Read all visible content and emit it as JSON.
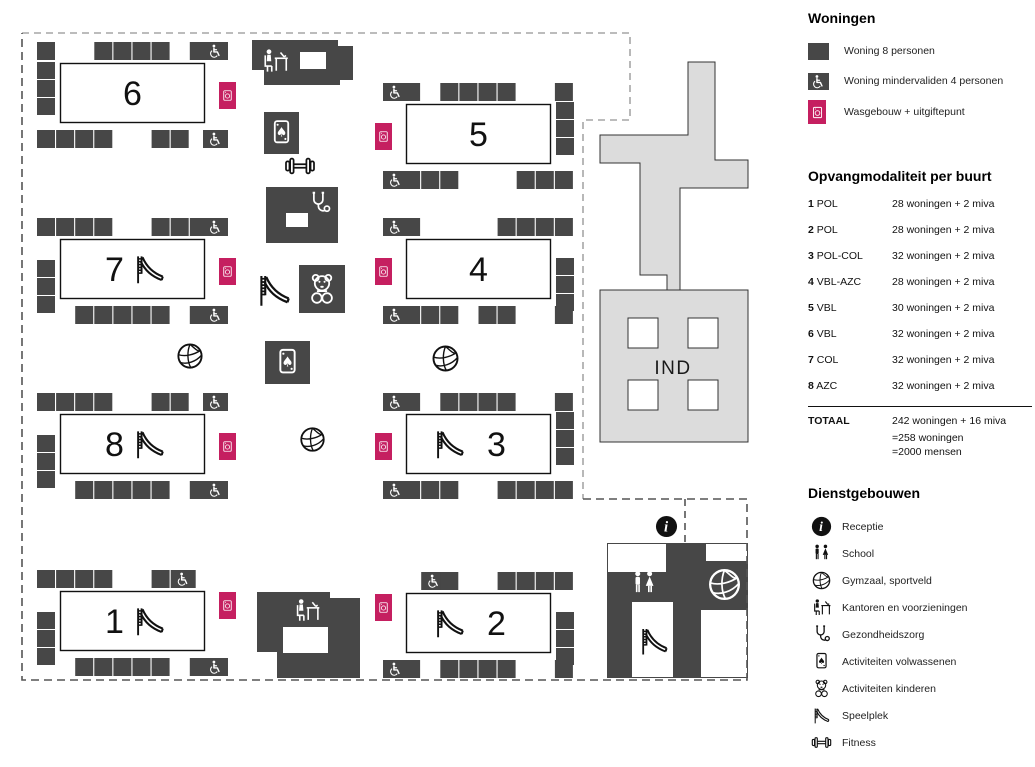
{
  "colors": {
    "dark": "#474747",
    "pink": "#c51f60",
    "light": "#dcdcdc",
    "boundary_light": "#a6a6a6",
    "boundary_dark": "#555555"
  },
  "legend": {
    "woningen": {
      "title": "Woningen",
      "items": [
        {
          "icon": "unit8",
          "label": "Woning 8 personen"
        },
        {
          "icon": "miva",
          "label": "Woning mindervaliden 4 personen"
        },
        {
          "icon": "wash",
          "label": "Wasgebouw + uitgiftepunt"
        }
      ]
    },
    "modaliteit": {
      "title": "Opvangmodaliteit per buurt",
      "rows": [
        {
          "num": "1",
          "type": "POL",
          "value": "28 woningen + 2 miva"
        },
        {
          "num": "2",
          "type": "POL",
          "value": "28 woningen + 2 miva"
        },
        {
          "num": "3",
          "type": "POL-COL",
          "value": "32 woningen + 2 miva"
        },
        {
          "num": "4",
          "type": "VBL-AZC",
          "value": "28 woningen + 2 miva"
        },
        {
          "num": "5",
          "type": "VBL",
          "value": "30 woningen + 2 miva"
        },
        {
          "num": "6",
          "type": "VBL",
          "value": "32 woningen + 2 miva"
        },
        {
          "num": "7",
          "type": "COL",
          "value": "32 woningen + 2 miva"
        },
        {
          "num": "8",
          "type": "AZC",
          "value": "32 woningen + 2 miva"
        }
      ],
      "total_label": "TOTAAL",
      "total_value": "242 woningen + 16 miva",
      "total_extra": [
        "=258 woningen",
        "=2000 mensen"
      ]
    },
    "diensten": {
      "title": "Dienstgebouwen",
      "items": [
        {
          "icon": "info",
          "label": "Receptie"
        },
        {
          "icon": "school",
          "label": "School"
        },
        {
          "icon": "volleyball",
          "label": "Gymzaal, sportveld"
        },
        {
          "icon": "office",
          "label": "Kantoren en voorzieningen"
        },
        {
          "icon": "health",
          "label": "Gezondheidszorg"
        },
        {
          "icon": "cards",
          "label": "Activiteiten volwassenen"
        },
        {
          "icon": "teddy",
          "label": "Activiteiten kinderen"
        },
        {
          "icon": "slide",
          "label": "Speelplek"
        },
        {
          "icon": "fitness",
          "label": "Fitness"
        }
      ]
    }
  },
  "map": {
    "ind_label": "IND",
    "boundary_top": "M 22,33 H 630 V 120 H 583 V 499",
    "boundary_main": "M 583,499 H 747 V 680 H 22 V 33",
    "boundary_extra": "M 685,499 V 543",
    "blocks": [
      {
        "number": "6",
        "x": 37,
        "y": 42,
        "side": "left",
        "slide": null,
        "top": [
          1,
          0,
          0,
          1,
          1,
          1,
          1,
          0,
          1,
          "w"
        ],
        "bottom": [
          1,
          1,
          1,
          1,
          0,
          0,
          1,
          1,
          0,
          "w"
        ],
        "col": [
          20,
          38,
          56
        ],
        "laundry_y": 40
      },
      {
        "number": "7",
        "x": 37,
        "y": 218,
        "side": "left",
        "slide": "after",
        "top": [
          1,
          1,
          1,
          1,
          0,
          0,
          1,
          1,
          1,
          "w"
        ],
        "bottom": [
          0,
          0,
          1,
          1,
          1,
          1,
          1,
          0,
          1,
          "w"
        ],
        "col": [
          42,
          60,
          78
        ],
        "laundry_y": 40
      },
      {
        "number": "8",
        "x": 37,
        "y": 393,
        "side": "left",
        "slide": "after",
        "top": [
          1,
          1,
          1,
          1,
          0,
          0,
          1,
          1,
          0,
          "w"
        ],
        "bottom": [
          0,
          0,
          1,
          1,
          1,
          1,
          1,
          0,
          1,
          "w"
        ],
        "col": [
          42,
          60,
          78
        ],
        "laundry_y": 40
      },
      {
        "number": "1",
        "x": 37,
        "y": 570,
        "side": "left",
        "slide": "after",
        "top": [
          1,
          1,
          1,
          1,
          0,
          0,
          1,
          "w",
          0,
          0
        ],
        "bottom": [
          0,
          0,
          1,
          1,
          1,
          1,
          1,
          0,
          1,
          "w"
        ],
        "col": [
          42,
          60,
          78
        ],
        "laundry_y": 22
      },
      {
        "number": "5",
        "x": 383,
        "y": 83,
        "side": "right",
        "slide": null,
        "top": [
          "w",
          1,
          0,
          1,
          1,
          1,
          1,
          0,
          0,
          1
        ],
        "bottom": [
          "w",
          1,
          1,
          1,
          0,
          0,
          0,
          1,
          1,
          1
        ],
        "col": [
          19,
          37,
          55
        ],
        "laundry_y": 40
      },
      {
        "number": "4",
        "x": 383,
        "y": 218,
        "side": "right",
        "slide": null,
        "top": [
          "w",
          1,
          0,
          0,
          0,
          0,
          1,
          1,
          1,
          1
        ],
        "bottom": [
          "w",
          1,
          1,
          1,
          0,
          1,
          1,
          0,
          0,
          1
        ],
        "col": [
          40,
          58,
          76
        ],
        "laundry_y": 40
      },
      {
        "number": "3",
        "x": 383,
        "y": 393,
        "side": "right",
        "slide": "before",
        "top": [
          "w",
          1,
          0,
          1,
          1,
          1,
          1,
          0,
          0,
          1
        ],
        "bottom": [
          "w",
          1,
          1,
          1,
          0,
          0,
          1,
          1,
          1,
          1
        ],
        "col": [
          19,
          37,
          55
        ],
        "laundry_y": 40
      },
      {
        "number": "2",
        "x": 383,
        "y": 572,
        "side": "right",
        "slide": "before",
        "top": [
          0,
          0,
          "w",
          1,
          0,
          0,
          1,
          1,
          1,
          1
        ],
        "bottom": [
          "w",
          1,
          0,
          1,
          1,
          1,
          1,
          0,
          0,
          1
        ],
        "col": [
          40,
          58,
          76
        ],
        "laundry_y": 22
      }
    ],
    "facilities": [
      {
        "shape": "poly",
        "name": "ind-verbindingsgebouw",
        "fill": "light",
        "points": "688,62 715,62 715,160 748,160 748,188 680,188 680,290 667,290 667,275 640,275 640,163 600,163 600,135 688,135"
      },
      {
        "shape": "rect",
        "name": "ind-gebouw",
        "fill": "light",
        "x": 600,
        "y": 290,
        "w": 148,
        "h": 152
      },
      {
        "shape": "rect",
        "name": "ind-binnenplaats",
        "fill": "white",
        "outline": true,
        "x": 628,
        "y": 318,
        "w": 30,
        "h": 30
      },
      {
        "shape": "rect",
        "name": "ind-binnenplaats",
        "fill": "white",
        "outline": true,
        "x": 688,
        "y": 318,
        "w": 30,
        "h": 30
      },
      {
        "shape": "rect",
        "name": "ind-binnenplaats",
        "fill": "white",
        "outline": true,
        "x": 628,
        "y": 380,
        "w": 30,
        "h": 30
      },
      {
        "shape": "rect",
        "name": "ind-binnenplaats",
        "fill": "white",
        "outline": true,
        "x": 688,
        "y": 380,
        "w": 30,
        "h": 30
      },
      {
        "shape": "text",
        "name": "ind-label",
        "bind": "ind_label",
        "x": 673,
        "y": 374,
        "size": 19
      },
      {
        "shape": "poly",
        "name": "kantoren-noord",
        "fill": "dark",
        "points": "252,40 338,40 338,46 353,46 353,80 340,80 340,85 264,85 264,70 252,70"
      },
      {
        "shape": "rect",
        "name": "kantoren-noord-venster",
        "fill": "white",
        "x": 300,
        "y": 52,
        "w": 26,
        "h": 17
      },
      {
        "shape": "icon",
        "name": "office-icon",
        "icon": "office",
        "color": "white",
        "x": 260,
        "y": 46,
        "w": 30,
        "h": 30
      },
      {
        "shape": "rect",
        "name": "activiteiten-volwassenen-noord",
        "fill": "dark",
        "x": 264,
        "y": 112,
        "w": 35,
        "h": 42
      },
      {
        "shape": "icon",
        "name": "cards-icon",
        "icon": "cards",
        "color": "white",
        "x": 266,
        "y": 116,
        "w": 31,
        "h": 34
      },
      {
        "shape": "icon",
        "name": "fitness-icon",
        "icon": "fitness",
        "color": "black",
        "x": 277,
        "y": 150,
        "w": 46,
        "h": 32
      },
      {
        "shape": "rect",
        "name": "gezondheidszorg-gebouw",
        "fill": "dark",
        "x": 266,
        "y": 187,
        "w": 72,
        "h": 56
      },
      {
        "shape": "rect",
        "name": "gezondheidszorg-venster",
        "fill": "white",
        "x": 286,
        "y": 213,
        "w": 22,
        "h": 14
      },
      {
        "shape": "icon",
        "name": "health-icon",
        "icon": "health",
        "color": "white",
        "x": 306,
        "y": 190,
        "w": 27,
        "h": 27
      },
      {
        "shape": "icon",
        "name": "slide-icon",
        "icon": "slide",
        "color": "black",
        "x": 253,
        "y": 268,
        "w": 42,
        "h": 44
      },
      {
        "shape": "rect",
        "name": "activiteiten-kinderen-gebouw",
        "fill": "dark",
        "x": 299,
        "y": 265,
        "w": 46,
        "h": 48
      },
      {
        "shape": "icon",
        "name": "teddy-icon",
        "icon": "teddy",
        "color": "white",
        "x": 304,
        "y": 271,
        "w": 36,
        "h": 36
      },
      {
        "shape": "rect",
        "name": "activiteiten-volwassenen-zuid",
        "fill": "dark",
        "x": 265,
        "y": 341,
        "w": 45,
        "h": 43
      },
      {
        "shape": "icon",
        "name": "cards-icon",
        "icon": "cards",
        "color": "white",
        "x": 271,
        "y": 345,
        "w": 33,
        "h": 35
      },
      {
        "shape": "icon",
        "name": "volleyball-icon",
        "icon": "volleyball",
        "color": "black",
        "x": 175,
        "y": 341,
        "w": 30,
        "h": 30
      },
      {
        "shape": "icon",
        "name": "volleyball-icon",
        "icon": "volleyball",
        "color": "black",
        "x": 430,
        "y": 343,
        "w": 31,
        "h": 31
      },
      {
        "shape": "icon",
        "name": "volleyball-icon",
        "icon": "volleyball",
        "color": "black",
        "x": 298,
        "y": 425,
        "w": 29,
        "h": 29
      },
      {
        "shape": "poly",
        "name": "kantoren-zuid",
        "fill": "dark",
        "points": "257,592 330,592 330,598 360,598 360,678 277,678 277,652 257,652"
      },
      {
        "shape": "rect",
        "name": "kantoren-zuid-venster",
        "fill": "white",
        "x": 283,
        "y": 627,
        "w": 45,
        "h": 26
      },
      {
        "shape": "icon",
        "name": "office-icon",
        "icon": "office",
        "color": "white",
        "x": 292,
        "y": 596,
        "w": 30,
        "h": 29
      },
      {
        "shape": "rect",
        "name": "receptie-school-gebouw",
        "fill": "dark",
        "x": 607,
        "y": 543,
        "w": 141,
        "h": 135
      },
      {
        "shape": "rect",
        "name": "receptie-uitsparing",
        "fill": "white",
        "x": 608,
        "y": 544,
        "w": 58,
        "h": 28
      },
      {
        "shape": "rect",
        "name": "receptie-uitsparing",
        "fill": "white",
        "x": 706,
        "y": 544,
        "w": 41,
        "h": 17
      },
      {
        "shape": "rect",
        "name": "receptie-uitsparing",
        "fill": "white",
        "x": 701,
        "y": 610,
        "w": 46,
        "h": 67
      },
      {
        "shape": "rect",
        "name": "school-binnenplaats",
        "fill": "white",
        "x": 632,
        "y": 602,
        "w": 41,
        "h": 75
      },
      {
        "shape": "rect",
        "name": "gymzaal",
        "fill": "dark",
        "x": 701,
        "y": 561,
        "w": 47,
        "h": 48
      },
      {
        "shape": "icon",
        "name": "volleyball-icon",
        "icon": "volleyball",
        "color": "white",
        "x": 706,
        "y": 566,
        "w": 37,
        "h": 37
      },
      {
        "shape": "icon",
        "name": "school-icon",
        "icon": "school",
        "color": "white",
        "x": 628,
        "y": 569,
        "w": 32,
        "h": 30
      },
      {
        "shape": "icon",
        "name": "slide-icon",
        "icon": "slide",
        "color": "black",
        "x": 636,
        "y": 620,
        "w": 36,
        "h": 42
      },
      {
        "shape": "icon",
        "name": "receptie-icon",
        "icon": "info",
        "color": "black",
        "x": 655,
        "y": 515,
        "w": 23,
        "h": 23
      }
    ]
  }
}
